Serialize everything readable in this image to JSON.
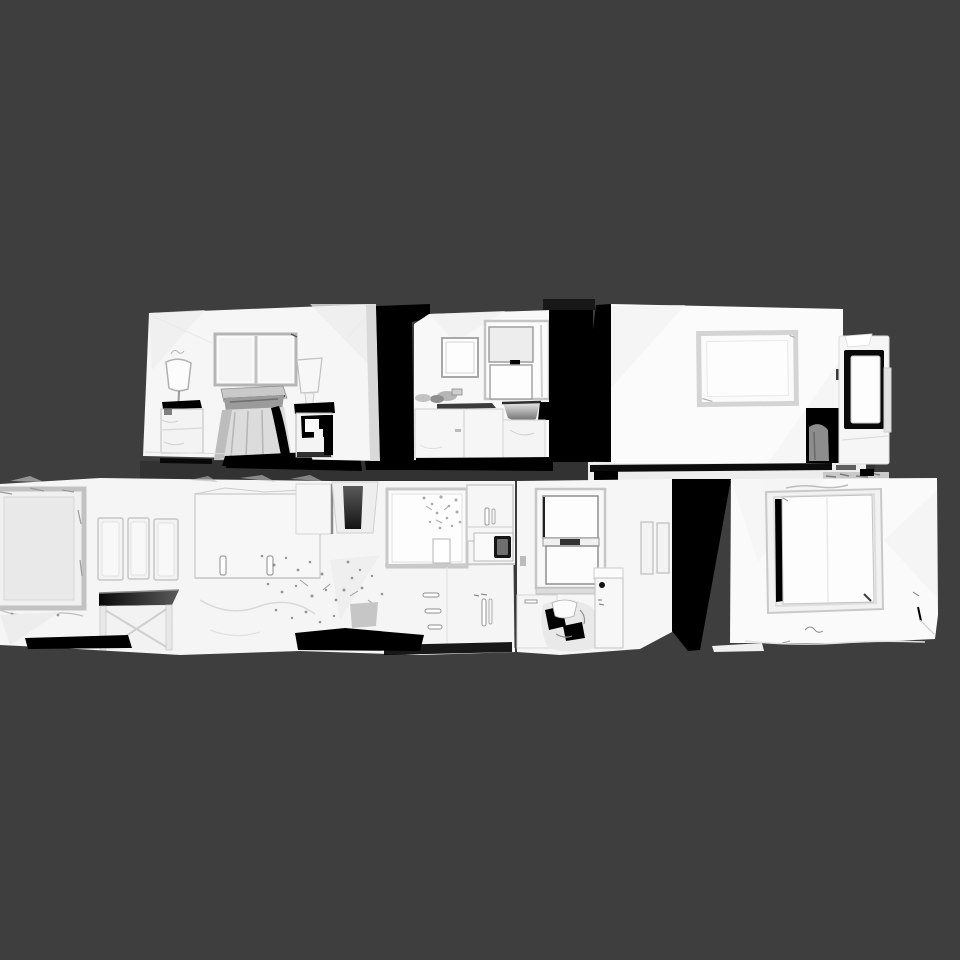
{
  "viewer": {
    "kind": "3d-mesh-viewport",
    "background_color": "#3e3e3e",
    "inter_floor_band_color": "#323232"
  },
  "palette": {
    "mesh_white": "#f6f6f6",
    "mesh_bright": "#f8f8f8",
    "mesh_lit": "#fbfbfb",
    "mesh_lit2": "#fafafa",
    "mesh_pale": "#f5f5f5",
    "floor_slab": "#ededed",
    "shadow_black": "#000000",
    "frame_gray": "#c6c6c6",
    "drape_mid": "#9b9b9b",
    "drape_light": "#dcdcdc",
    "blob_gray": "#8d8d8d"
  },
  "scene": {
    "floors": [
      {
        "name": "upper-floor",
        "rooms": [
          {
            "name": "bedroom",
            "objects": [
              "double-window",
              "floor-lamp",
              "dresser",
              "draped-bed",
              "table-lamp",
              "nightstand"
            ]
          },
          {
            "name": "bathroom",
            "objects": [
              "mirror",
              "sash-window",
              "sink",
              "vanity",
              "faucet"
            ]
          },
          {
            "name": "living-room",
            "objects": [
              "wall-frame",
              "open-doorway",
              "glass-door-panel"
            ]
          }
        ]
      },
      {
        "name": "lower-floor",
        "rooms": [
          {
            "name": "study-wall",
            "objects": [
              "picture-frame",
              "wall-panels",
              "desk",
              "wall-cabinet"
            ]
          },
          {
            "name": "kitchen",
            "objects": [
              "range-hood",
              "window-with-plants",
              "wall-cabinet",
              "microwave",
              "drawer-stack",
              "counter",
              "toe-kick"
            ]
          },
          {
            "name": "laundry-nook",
            "objects": [
              "sash-window",
              "base-cabinet",
              "laundry-pile",
              "side-cabinet",
              "wall-frames"
            ]
          },
          {
            "name": "end-bedroom",
            "objects": [
              "large-window"
            ]
          }
        ]
      }
    ]
  }
}
